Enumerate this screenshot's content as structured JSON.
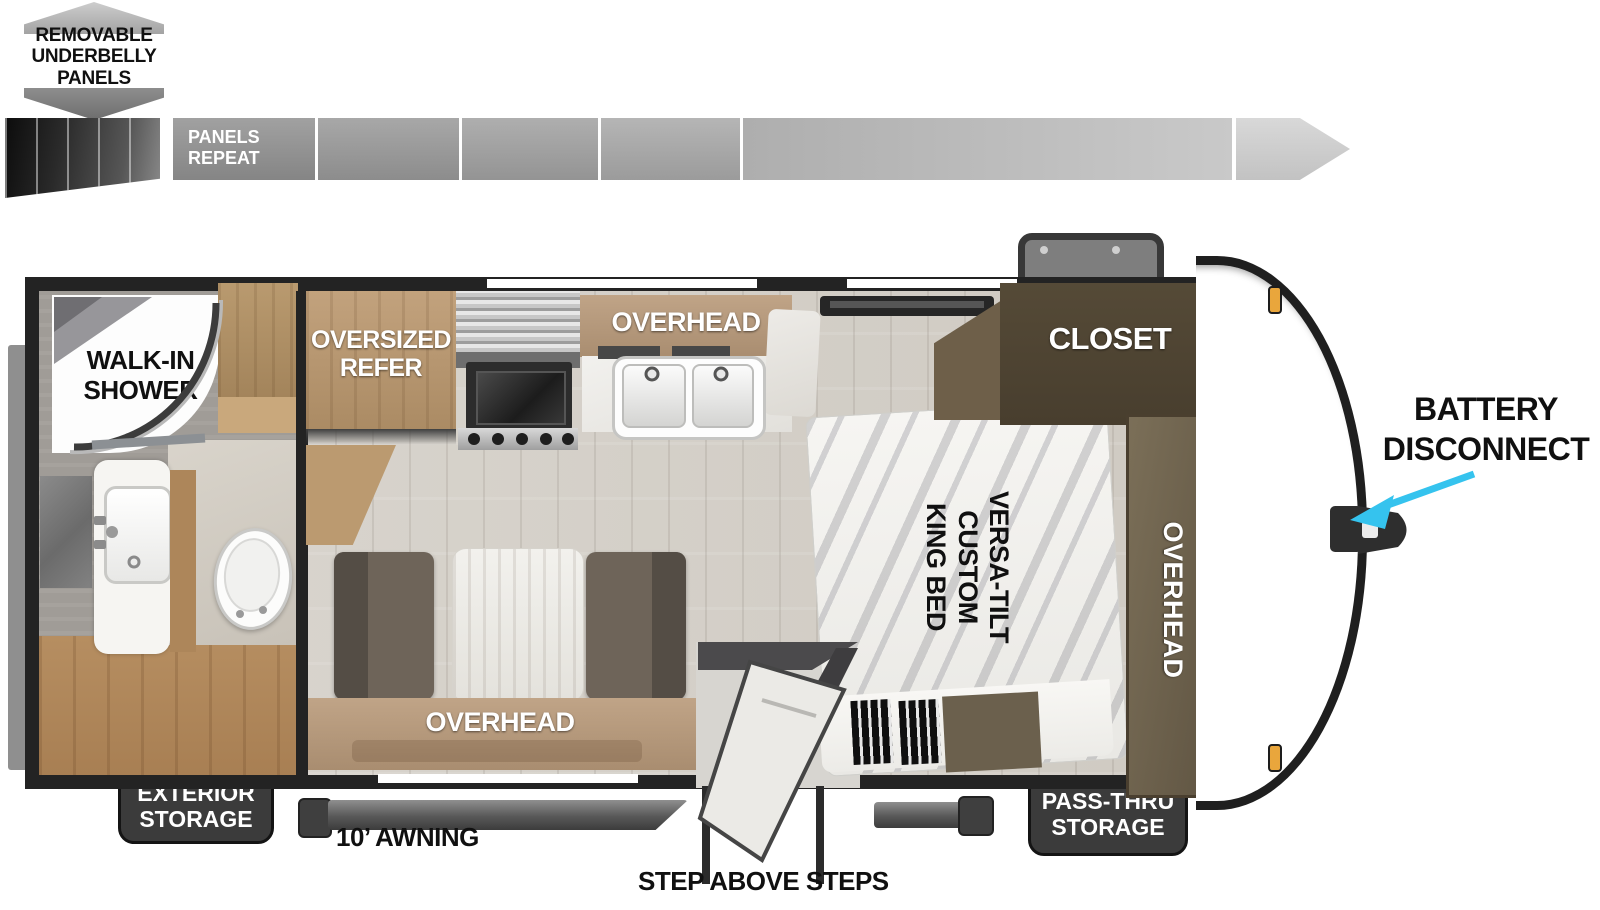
{
  "title": "Travel trailer floor plan",
  "underbelly_note": "REMOVABLE\nUNDERBELLY\nPANELS",
  "panels_bar": {
    "label": "PANELS\nREPEAT"
  },
  "rooms": {
    "shower": "WALK-IN\nSHOWER",
    "refer": "OVERSIZED\nREFER",
    "kitchen_overhead": "OVERHEAD",
    "dinette_overhead": "OVERHEAD",
    "closet": "CLOSET",
    "bed": "VERSA-TILT\nCUSTOM\nKING BED",
    "bed_overhead": "OVERHEAD"
  },
  "callouts": {
    "battery": "BATTERY\nDISCONNECT",
    "exterior_storage": "EXTERIOR\nSTORAGE",
    "awning": "10’ AWNING",
    "steps": "STEP ABOVE STEPS",
    "pass_thru": "PASS-THRU\nSTORAGE"
  },
  "colors": {
    "accent_arrow": "#35c3ee",
    "badge_bg": "#3b3b3b",
    "wall": "#232323",
    "wood": "#b99a76",
    "closet_wood": "#4f4533",
    "floor": "#d8d4cd"
  }
}
